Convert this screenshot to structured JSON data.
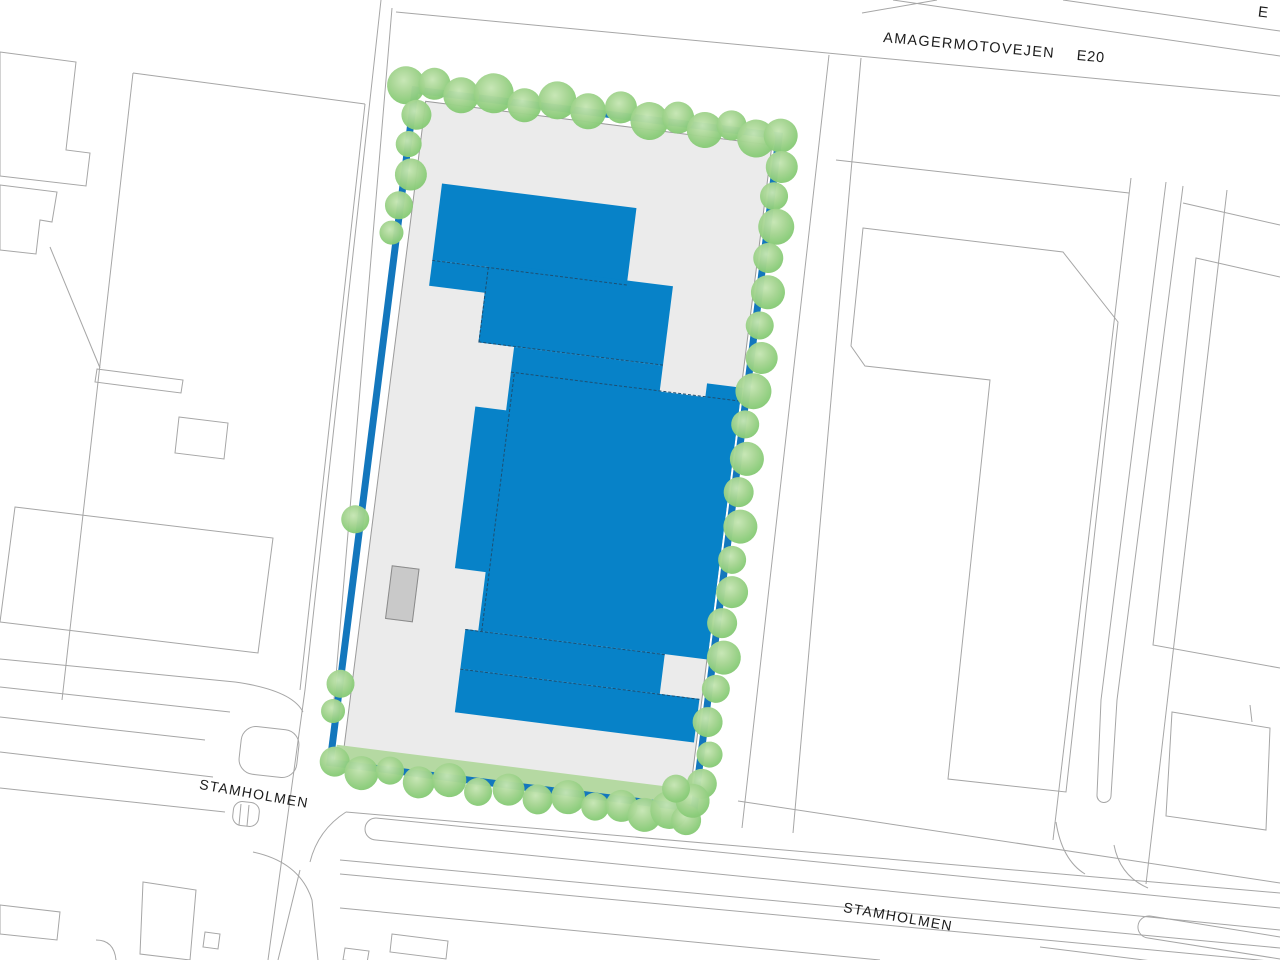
{
  "map_labels": {
    "motorway_name": "AMAGERMOTOVEJEN",
    "motorway_number": "E20",
    "street_west": "STAMHOLMEN",
    "street_south": "STAMHOLMEN",
    "edge_partial": "E"
  },
  "colors": {
    "site_boundary": "#1377bd",
    "building_fill": "#0782c8",
    "tree_green": "#8ccd7b",
    "tree_green_light": "#c6e6b4",
    "site_ground": "#ebebeb",
    "lawn_strip": "#b5d9a2",
    "map_line": "#a6a6a6",
    "dash_line": "#1d4f72",
    "shed_fill": "#c9c9c9",
    "background": "#ffffff",
    "label_text": "#1c1c1c"
  }
}
